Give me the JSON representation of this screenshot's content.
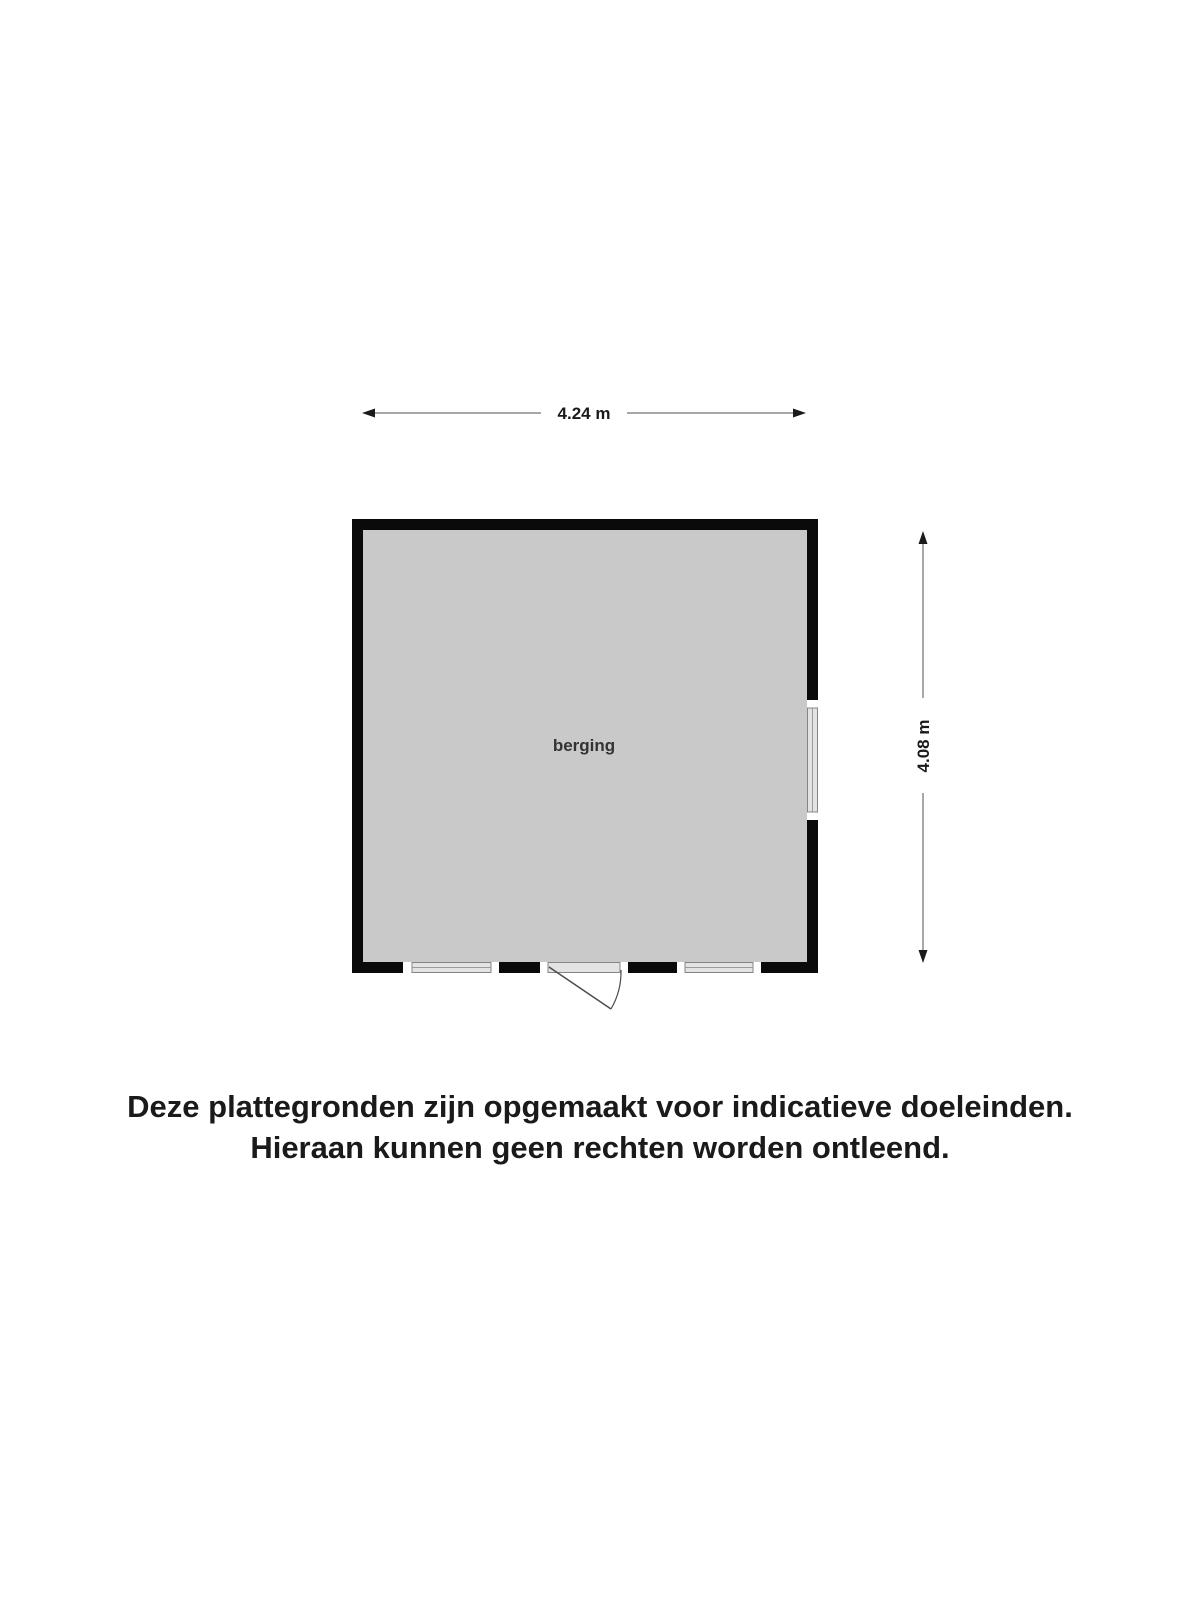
{
  "floor_plan": {
    "room_label": "berging",
    "dimension_width_label": "4.24 m",
    "dimension_height_label": "4.08 m"
  },
  "disclaimer": {
    "line1": "Deze plattegronden zijn opgemaakt voor indicatieve doeleinden.",
    "line2": "Hieraan kunnen geen rechten worden ontleend."
  },
  "colors": {
    "wall": "#0a0a0a",
    "room_fill": "#c9c9c9",
    "window_fill": "#e3e3e3",
    "window_border": "#858585",
    "window_cap": "#ffffff",
    "door_swing_line": "#4d4d4d",
    "dimension_line": "#8c8c8c",
    "arrowhead": "#1a1a1a",
    "dimension_text": "#1a1a1a",
    "room_label_text": "#333333",
    "disclaimer_text": "#1a1a1a",
    "background": "#ffffff"
  }
}
